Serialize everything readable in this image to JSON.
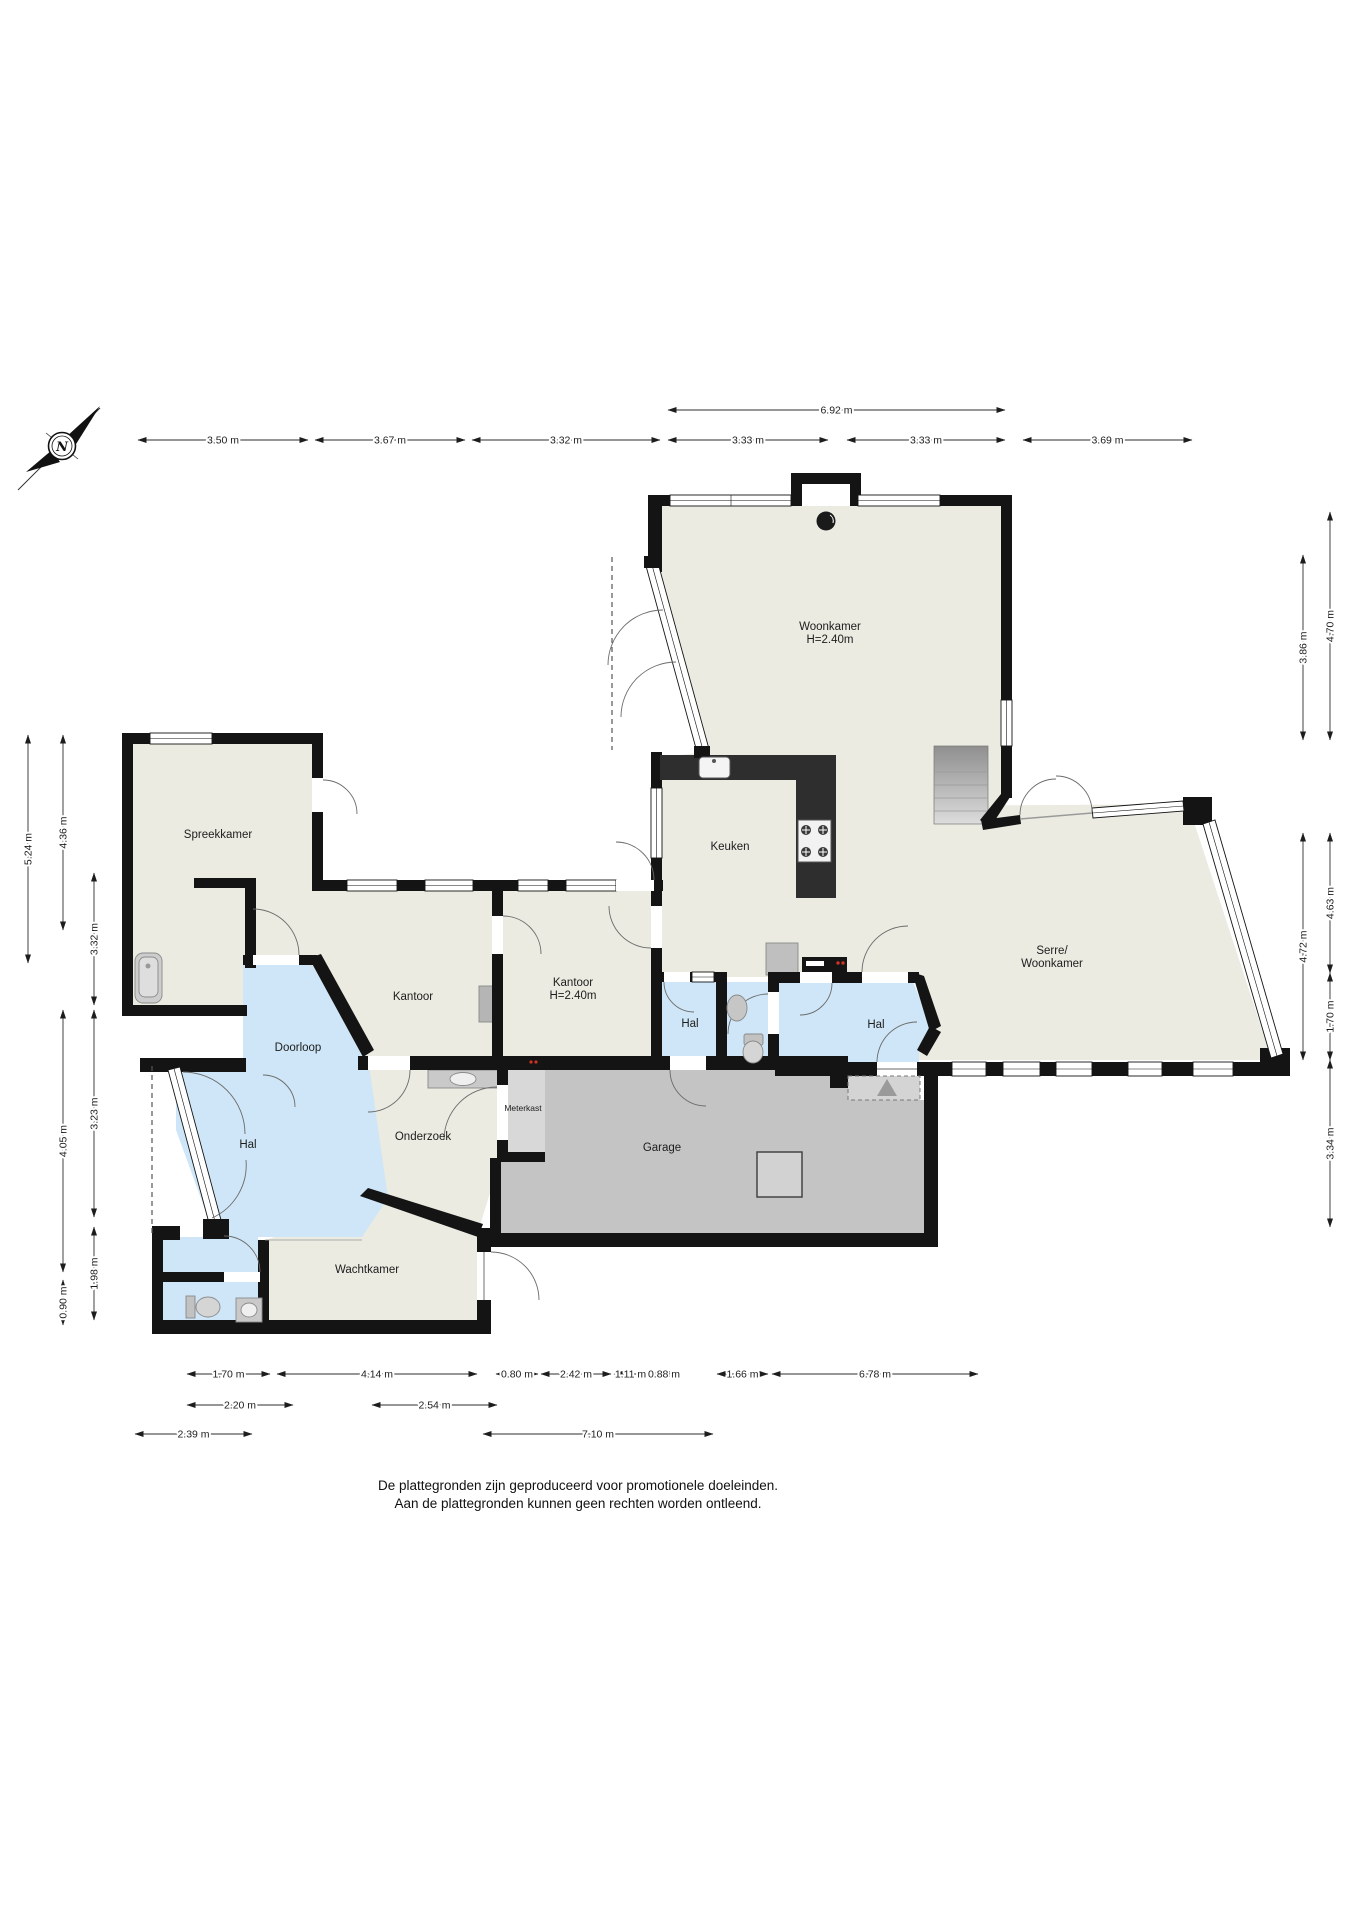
{
  "compass": {
    "label": "N"
  },
  "rooms": [
    {
      "id": "woonkamer",
      "label": "Woonkamer",
      "sublabel": "H=2.40m",
      "x": 830,
      "y": 630
    },
    {
      "id": "spreekkamer",
      "label": "Spreekkamer",
      "x": 218,
      "y": 838
    },
    {
      "id": "keuken",
      "label": "Keuken",
      "x": 730,
      "y": 850
    },
    {
      "id": "kantoor-1",
      "label": "Kantoor",
      "x": 413,
      "y": 1000
    },
    {
      "id": "kantoor-2",
      "label": "Kantoor",
      "sublabel": "H=2.40m",
      "x": 573,
      "y": 986
    },
    {
      "id": "hal-klein",
      "label": "Hal",
      "x": 690,
      "y": 1027
    },
    {
      "id": "hal-rechts",
      "label": "Hal",
      "x": 876,
      "y": 1028
    },
    {
      "id": "serre",
      "label": "Serre/",
      "sublabel": "Woonkamer",
      "x": 1052,
      "y": 954
    },
    {
      "id": "doorloop",
      "label": "Doorloop",
      "x": 298,
      "y": 1051
    },
    {
      "id": "hal-links",
      "label": "Hal",
      "x": 248,
      "y": 1148
    },
    {
      "id": "onderzoek",
      "label": "Onderzoek",
      "x": 423,
      "y": 1140
    },
    {
      "id": "meterkast",
      "label": "Meterkast",
      "small": true,
      "x": 523,
      "y": 1111
    },
    {
      "id": "garage",
      "label": "Garage",
      "x": 662,
      "y": 1151
    },
    {
      "id": "wachtkamer",
      "label": "Wachtkamer",
      "x": 367,
      "y": 1273
    }
  ],
  "dimensions": {
    "horizontal": [
      {
        "label": "6.92 m",
        "x1": 668,
        "x2": 1005,
        "y": 410
      },
      {
        "label": "3.50 m",
        "x1": 138,
        "x2": 308,
        "y": 440
      },
      {
        "label": "3.67 m",
        "x1": 315,
        "x2": 465,
        "y": 440
      },
      {
        "label": "3.32 m",
        "x1": 472,
        "x2": 660,
        "y": 440
      },
      {
        "label": "3.33 m",
        "x1": 668,
        "x2": 828,
        "y": 440
      },
      {
        "label": "3.33 m",
        "x1": 847,
        "x2": 1005,
        "y": 440
      },
      {
        "label": "3.69 m",
        "x1": 1023,
        "x2": 1192,
        "y": 440
      },
      {
        "label": "1.70 m",
        "x1": 187,
        "x2": 270,
        "y": 1374
      },
      {
        "label": "4.14 m",
        "x1": 277,
        "x2": 477,
        "y": 1374
      },
      {
        "label": "0.80 m",
        "x1": 496,
        "x2": 538,
        "y": 1374
      },
      {
        "label": "2.42 m",
        "x1": 541,
        "x2": 611,
        "y": 1374
      },
      {
        "label": "1.11 m",
        "x1": 614,
        "x2": 647,
        "y": 1374
      },
      {
        "label": "0.88 m",
        "x1": 650,
        "x2": 678,
        "y": 1374
      },
      {
        "label": "1.66 m",
        "x1": 717,
        "x2": 768,
        "y": 1374
      },
      {
        "label": "6.78 m",
        "x1": 772,
        "x2": 978,
        "y": 1374
      },
      {
        "label": "2.20 m",
        "x1": 187,
        "x2": 293,
        "y": 1405
      },
      {
        "label": "2.54 m",
        "x1": 372,
        "x2": 497,
        "y": 1405
      },
      {
        "label": "2.39 m",
        "x1": 135,
        "x2": 252,
        "y": 1434
      },
      {
        "label": "7.10 m",
        "x1": 483,
        "x2": 713,
        "y": 1434
      }
    ],
    "vertical": [
      {
        "label": "4.70 m",
        "x": 1330,
        "y1": 512,
        "y2": 740
      },
      {
        "label": "3.86 m",
        "x": 1303,
        "y1": 555,
        "y2": 740
      },
      {
        "label": "4.63 m",
        "x": 1330,
        "y1": 833,
        "y2": 973
      },
      {
        "label": "4.72 m",
        "x": 1303,
        "y1": 833,
        "y2": 1060
      },
      {
        "label": "1.70 m",
        "x": 1330,
        "y1": 973,
        "y2": 1060
      },
      {
        "label": "3.34 m",
        "x": 1330,
        "y1": 1060,
        "y2": 1227
      },
      {
        "label": "5.24 m",
        "x": 28,
        "y1": 735,
        "y2": 963
      },
      {
        "label": "4.36 m",
        "x": 63,
        "y1": 735,
        "y2": 930
      },
      {
        "label": "3.32 m",
        "x": 94,
        "y1": 873,
        "y2": 1005
      },
      {
        "label": "4.05 m",
        "x": 63,
        "y1": 1010,
        "y2": 1272
      },
      {
        "label": "3.23 m",
        "x": 94,
        "y1": 1010,
        "y2": 1217
      },
      {
        "label": "1.98 m",
        "x": 94,
        "y1": 1227,
        "y2": 1320
      },
      {
        "label": "0.90 m",
        "x": 63,
        "y1": 1280,
        "y2": 1325
      }
    ]
  },
  "footer": {
    "line1": "De plattegronden zijn geproduceerd voor promotionele doeleinden.",
    "line2": "Aan de plattegronden kunnen geen rechten worden ontleend."
  },
  "colors": {
    "room_cream": "#EBEBE2",
    "hall_blue": "#CEE6F7",
    "garage_gray": "#C4C4C4",
    "meterkast_gray": "#D8D8D8",
    "wall_black": "#141414",
    "counter_dark": "#2E2E2E"
  }
}
